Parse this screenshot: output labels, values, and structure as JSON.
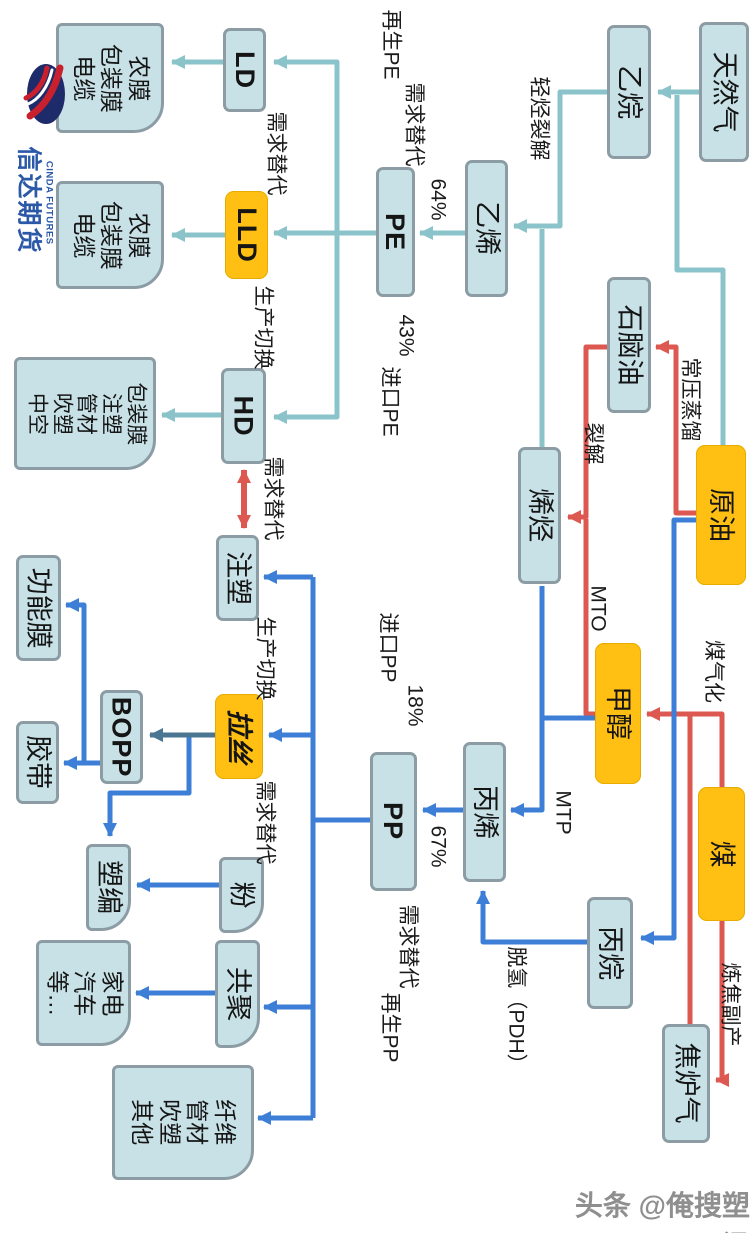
{
  "logo": {
    "cn": "信达期货",
    "en": "CINDA FUTURES"
  },
  "watermark": "头条 @俺搜塑讯",
  "colors": {
    "node_fill": "#c7e1e6",
    "node_border": "#8c9ca4",
    "highlight_orange": "#ffc013",
    "flow_teal": "#8ac3ca",
    "flow_blue": "#3d7fd6",
    "flow_red": "#dd5850",
    "flow_steel": "#4a7691"
  },
  "boxes": {
    "natural_gas": "天然气",
    "ethane": "乙烷",
    "ethylene": "乙烯",
    "pe": "PE",
    "naphtha": "石脑油",
    "olefins": "烯烃",
    "crude_oil": "原油",
    "methanol": "甲醇",
    "coal": "煤",
    "propane": "丙烷",
    "coke_oven_gas": "焦炉气",
    "propylene": "丙烯",
    "pp": "PP",
    "ld": "LD",
    "lld": "LLD",
    "hd": "HD",
    "injection": "注塑",
    "drawing": "拉丝",
    "bopp": "BOPP",
    "powder": "粉",
    "copolymer": "共聚",
    "plastic_weaving": "塑编",
    "functional_film": "功能膜",
    "tape": "胶带",
    "film_uses_1": "农膜\n包装膜\n电缆",
    "film_uses_2": "农膜\n包装膜\n电缆",
    "hd_uses": "包装膜\n注塑\n管材\n吹塑\n中空",
    "appliance_uses": "家电\n汽车\n等…",
    "fiber_uses": "纤维\n管材\n吹塑\n其他"
  },
  "labels": {
    "recycled_pe": "再生PE",
    "demand_sub_pe": "需求替代",
    "light_cracking": "轻烃裂解",
    "pct_64": "64%",
    "pct_43": "43%",
    "import_pe": "进口PE",
    "demand_sub_ld": "需求替代",
    "prod_switch_lld": "生产切换",
    "demand_sub_hd": "需求替代",
    "prod_switch_inj": "生产切换",
    "demand_sub_draw": "需求替代",
    "atm_distill": "常压蒸馏",
    "cracking": "裂解",
    "mto": "MTO",
    "mtp": "MTP",
    "coal_gasification": "煤气化",
    "import_pp": "进口PP",
    "pct_18": "18%",
    "pct_67": "67%",
    "demand_sub_pp": "需求替代",
    "recycled_pp": "再生PP",
    "pdh": "脱氢（PDH）",
    "coking_byproduct": "炼焦副产"
  }
}
